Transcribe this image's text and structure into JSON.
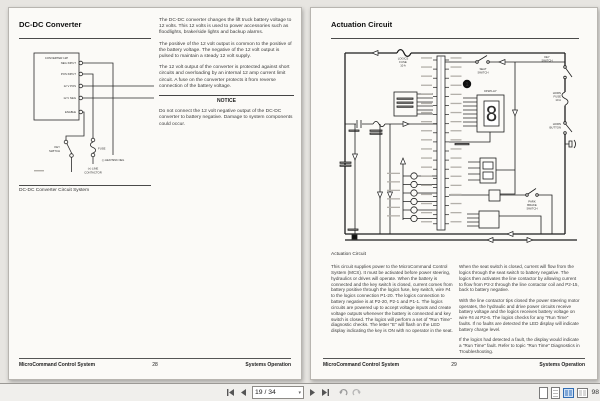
{
  "statusbar": {
    "page_indicator": "19 / 34",
    "zoom_percent": "98"
  },
  "left_page": {
    "title": "DC-DC Converter",
    "paragraphs": [
      "The DC-DC converter changes the lift truck battery voltage to 12 volts. This 12 volts is used to power accessories such as floodlights, brake/side lights and backup alarms.",
      "The positive of the 12 volt output is common to the positive of the battery voltage. The negative of the 12 volt output is pulsed to maintain a steady 12 volt supply.",
      "The 12 volt output of the converter is protected against short circuits and overloading by an internal 12 amp current limit circuit. A fuse on the converter protects it from reverse connection of the battery voltage."
    ],
    "notice": {
      "heading": "NOTICE",
      "body": "Do not connect the 12 volt negative output of the DC-DC converter to battery negative. Damage to system components could occur."
    },
    "diagram": {
      "box_title": "CONVERTER 12P",
      "terminals": [
        "NEG INPUT",
        "POS INPUT",
        "12 V POS",
        "12 V NEG",
        "ENABLE"
      ],
      "key_switch": [
        "KEY",
        "SWITCH"
      ],
      "fuse": "FUSE",
      "line_contactor": [
        "(+) LINE",
        "CONTACTOR"
      ],
      "heatsink": "(-) HEATSINK NEG",
      "caption": "DC-DC Converter Circuit System"
    },
    "footer": {
      "product": "MicroCommand Control System",
      "page": "28",
      "section": "Systems Operation"
    }
  },
  "right_page": {
    "title": "Actuation Circuit",
    "diagram_caption": "Actuation Circuit",
    "diagram": {
      "logics_fuse": [
        "LOGICS",
        "FUSE",
        "10 A"
      ],
      "key_switch": [
        "KEY",
        "SWITCH"
      ],
      "seat_switch": [
        "SEAT",
        "SWITCH"
      ],
      "horn_fuse": [
        "HORN",
        "FUSE",
        "10 A"
      ],
      "horn_button": [
        "HORN",
        "BUTTON"
      ],
      "park_brake": [
        "PARK",
        "BRAKE",
        "SWITCH"
      ],
      "display_label": "DISPLAY",
      "display_digit": "8",
      "callout_1": "1"
    },
    "col1_paragraphs": [
      "This circuit supplies power to the MicroCommand Control System (MCS). It must be activated before power steering, hydraulics or drives will operate. When the battery is connected and the key switch is closed, current comes from battery positive through the logics fuse, key switch, wire #4 to the logics connection P1-20. The logics connection to battery negative is at P2-20, P2-1 and P1-1. The logics circuits are powered up to accept voltage inputs and create voltage outputs whenever the battery is connected and key switch is closed. The logics will perform a set of \"Run Time\" diagnostic checks. The letter \"E\" will flash on the LED display indicating the key is ON with no operator in the seat."
    ],
    "col2_paragraphs": [
      "When the seat switch is closed, current will flow from the logics through the seat switch to battery negative. The logics then activates the line contactor by allowing current to flow from P2-2 through the line contactor coil and P2-15, back to battery negative.",
      "With the line contactor tips closed the power steering motor operates, the hydraulic and drive power circuits receive battery voltage and the logics receives battery voltage on wire #4 at P2-6. The logics checks for any \"Run Time\" faults. If no faults are detected the LED display will indicate battery charge level.",
      "If the logics had detected a fault, the display would indicate a \"Run Time\" fault. Refer to topic \"Run Time\" Diagnostics in Troubleshooting."
    ],
    "footer": {
      "product": "MicroCommand Control System",
      "page": "29",
      "section": "Systems Operation"
    }
  }
}
